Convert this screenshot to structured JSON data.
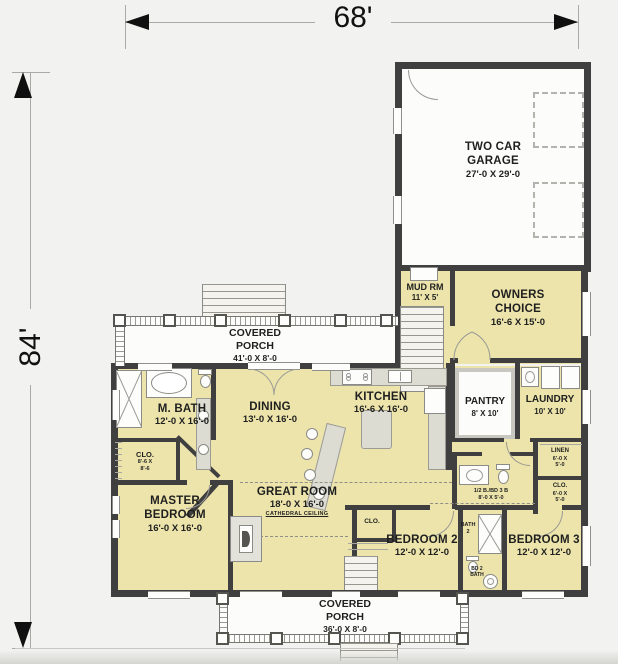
{
  "plan": {
    "overall_width": "68'",
    "overall_height": "84'"
  },
  "rooms": {
    "garage": {
      "name": "TWO CAR GARAGE",
      "size": "27'-0 X 29'-0"
    },
    "mud": {
      "name": "MUD RM",
      "size": "11' X 5'"
    },
    "owners": {
      "name": "OWNERS CHOICE",
      "size": "16'-6 X 15'-0"
    },
    "porch_top": {
      "name": "COVERED PORCH",
      "size": "41'-0 X 8'-0"
    },
    "mbath": {
      "name": "M. BATH",
      "size": "12'-0 X 16'-0"
    },
    "mclo": {
      "name": "CLO.",
      "size_l1": "8'-6 X",
      "size_l2": "8'-6"
    },
    "dining": {
      "name": "DINING",
      "size": "13'-0 X 16'-0"
    },
    "kitchen": {
      "name": "KITCHEN",
      "size": "16'-6 X 16'-0"
    },
    "pantry": {
      "name": "PANTRY",
      "size": "8' X 10'"
    },
    "laundry": {
      "name": "LAUNDRY",
      "size": "10' X 10'"
    },
    "linen": {
      "name": "LINEN",
      "size_l1": "6'-0 X",
      "size_l2": "5'-0"
    },
    "rclo": {
      "name": "CLO.",
      "size_l1": "6'-0 X",
      "size_l2": "5'-0"
    },
    "halfbath": {
      "name": "1/2 B./BD 3 B",
      "size": "8'-0 X 5'-0"
    },
    "master": {
      "name": "MASTER BEDROOM",
      "size": "16'-0 X 16'-0"
    },
    "great": {
      "name": "GREAT ROOM",
      "size": "18'-0 X 16'-0",
      "note": "CATHEDRAL CEILING"
    },
    "bed2": {
      "name": "BEDROOM 2",
      "size": "12'-0 X 12'-0"
    },
    "bed2clo": {
      "name": "CLO."
    },
    "bath2": {
      "name_l1": "BATH",
      "name_l2": "2"
    },
    "bd2bath": {
      "name_l1": "BD 2",
      "name_l2": "BATH"
    },
    "bed3": {
      "name": "BEDROOM 3",
      "size": "12'-0 X 12'-0"
    },
    "porch_bottom": {
      "name": "COVERED PORCH",
      "size": "36'-0 X 8'-0"
    }
  },
  "colors": {
    "room_fill": "#ece4ab",
    "wall": "#3f3f3f",
    "porch": "#fcfcfa",
    "background": "#f2f2f0"
  }
}
